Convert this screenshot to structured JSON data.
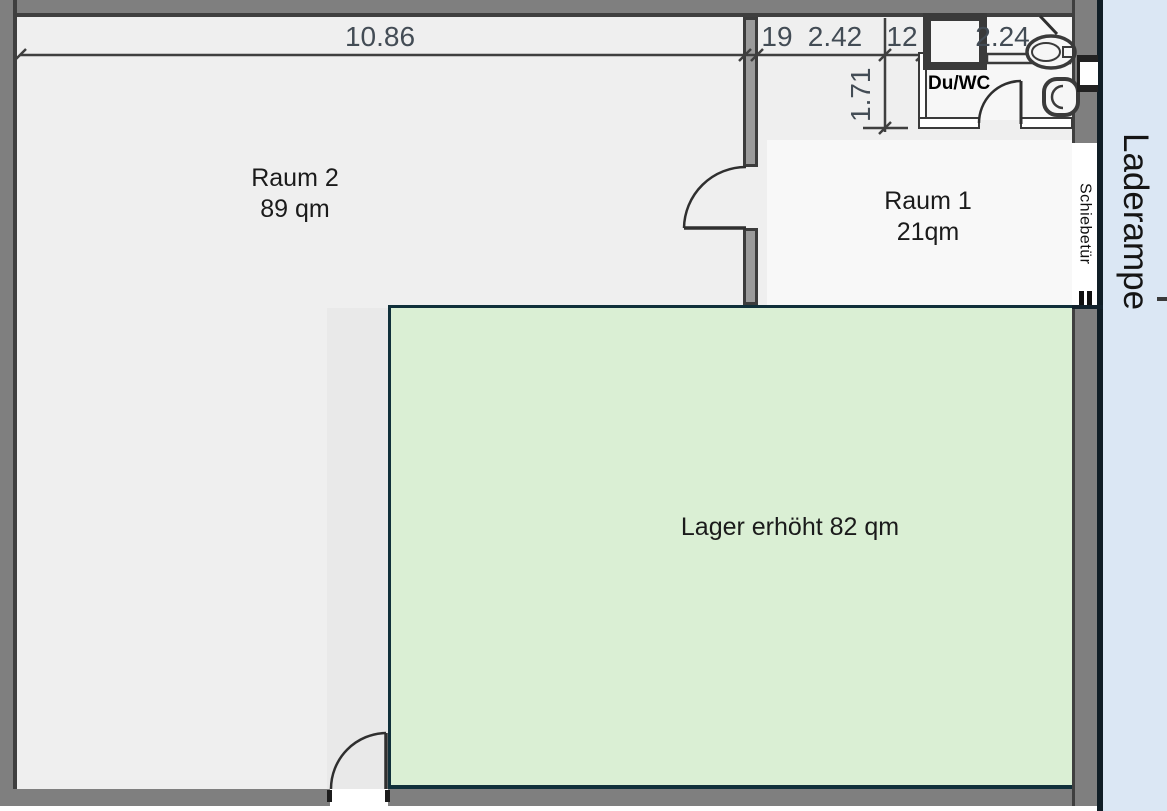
{
  "rooms": {
    "raum2": {
      "name": "Raum 2",
      "area": "89 qm"
    },
    "raum1": {
      "name": "Raum 1",
      "area": "21qm"
    },
    "lager": {
      "label": "Lager erhöht 82 qm"
    },
    "bath": {
      "label": "Du/WC"
    }
  },
  "annotations": {
    "sliding_door": "Schiebetür",
    "loading_ramp": "Laderampe"
  },
  "dimensions": {
    "total_width": "10.86",
    "wall_a": "19",
    "corridor_width": "2.42",
    "wall_b": "12",
    "bath_width": "2.24",
    "corridor_depth": "1.71"
  },
  "icons": {
    "shower_tray": "thick-square-outline",
    "sink": "oval-basin",
    "toilet": "rounded-bowl",
    "door_swing": "quarter-arc",
    "sliding_door": "double-bar"
  },
  "colors": {
    "floor": "#efefef",
    "room1_floor": "#f8f8f8",
    "passage_floor": "#e9e9e9",
    "wall_gray": "#7f7f7f",
    "wall_edge": "#3f3f3f",
    "interior_wall": "#9b9b9b",
    "lager_fill": "#daefd4",
    "lager_border": "#10303a",
    "ramp_fill": "#dbe7f4",
    "dimension_text": "#434c55"
  }
}
